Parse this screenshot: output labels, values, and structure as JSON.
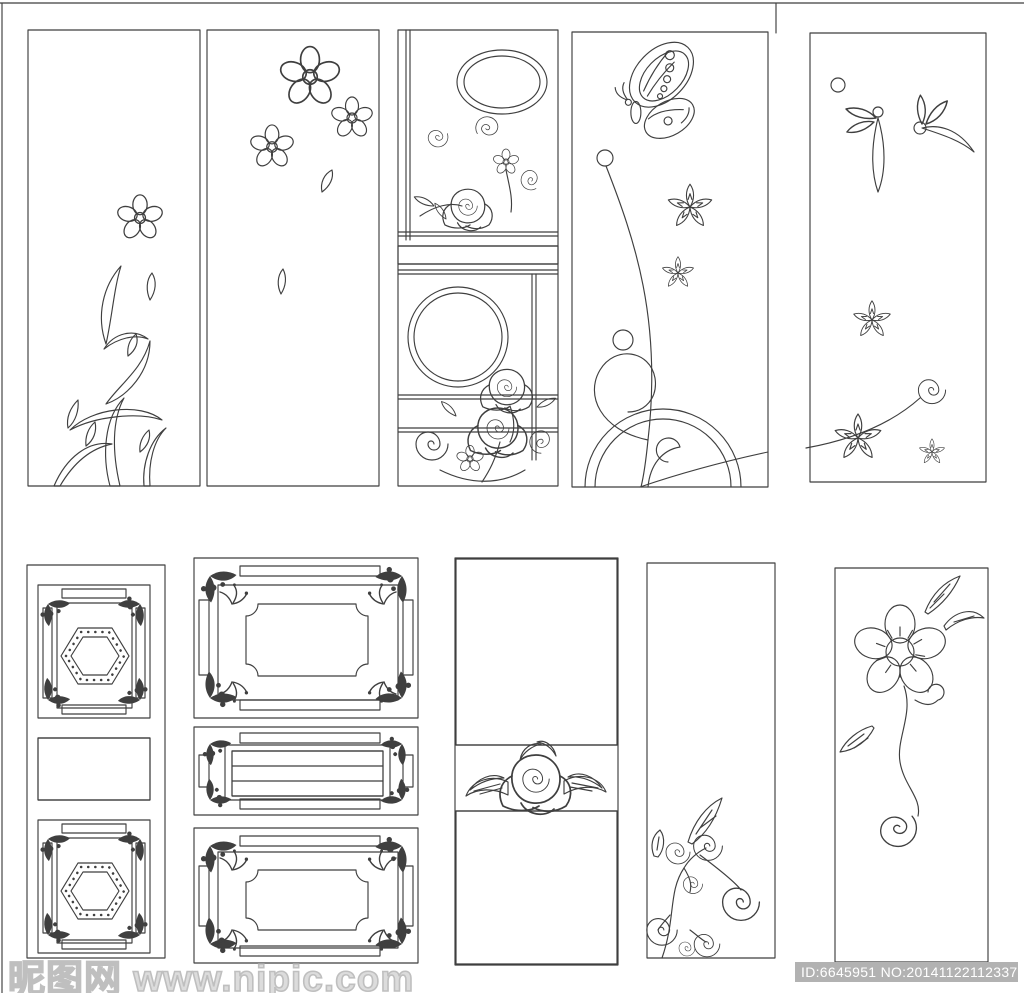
{
  "canvas": {
    "width": 1024,
    "height": 993,
    "kind": "etched-glass panel design sheet, black line art on white"
  },
  "colors": {
    "line": "#3f3f3f",
    "background": "#ffffff",
    "watermark_text": "#dcdcdc",
    "watermark_stroke": "#bfbfbf",
    "id_bar": "#b2b2b2",
    "id_text": "#ffffff"
  },
  "watermark": {
    "site_text": "昵图网 www.nipic.com",
    "id_text": "ID:6645951 NO:20141122112337151000"
  },
  "panels": {
    "top_row": [
      {
        "id": "vine-flower",
        "description": "Tall panel with a five-petal flower atop a curving thorn vine with leaves rising from the bottom left"
      },
      {
        "id": "falling-blossoms",
        "description": "Tall panel with three five-petal blossoms in the upper right and two falling petals below"
      },
      {
        "id": "ornate-mirror-panel",
        "description": "Ornate panel with left stile, double oval, swirl roses, diamond band, large double circle and corner roses"
      },
      {
        "id": "butterfly-garden",
        "description": "Panel with a butterfly above star flowers, a long curving stem from a dot, loop flourish and double arch at the base"
      },
      {
        "id": "leaf-spray",
        "description": "Panel with leaf sprays and berry dots at the top right and star flowers with a spiral flourish at the bottom"
      }
    ],
    "bottom_row": [
      {
        "id": "hexagon-medallions",
        "description": "Narrow panel with two ornate chain-bordered frames holding dotted hexagon medallions separated by a lattice band"
      },
      {
        "id": "triple-ornate-frames",
        "description": "Wide panel of three stacked ornate frames with chain borders, dark corner florets, notched inner frames and a grid band"
      },
      {
        "id": "quilted-rose",
        "description": "Panel filled with a wavy quilted lattice split by a white band holding a rose and leaves"
      },
      {
        "id": "spiral-branch",
        "description": "Plain panel with a swirling spiral branch and two feather leaves in the lower left corner"
      },
      {
        "id": "flower-swirl-stem",
        "description": "Panel with a large open five-petal flower with stamen ring, feather leaves and a long spiral stem"
      }
    ]
  }
}
